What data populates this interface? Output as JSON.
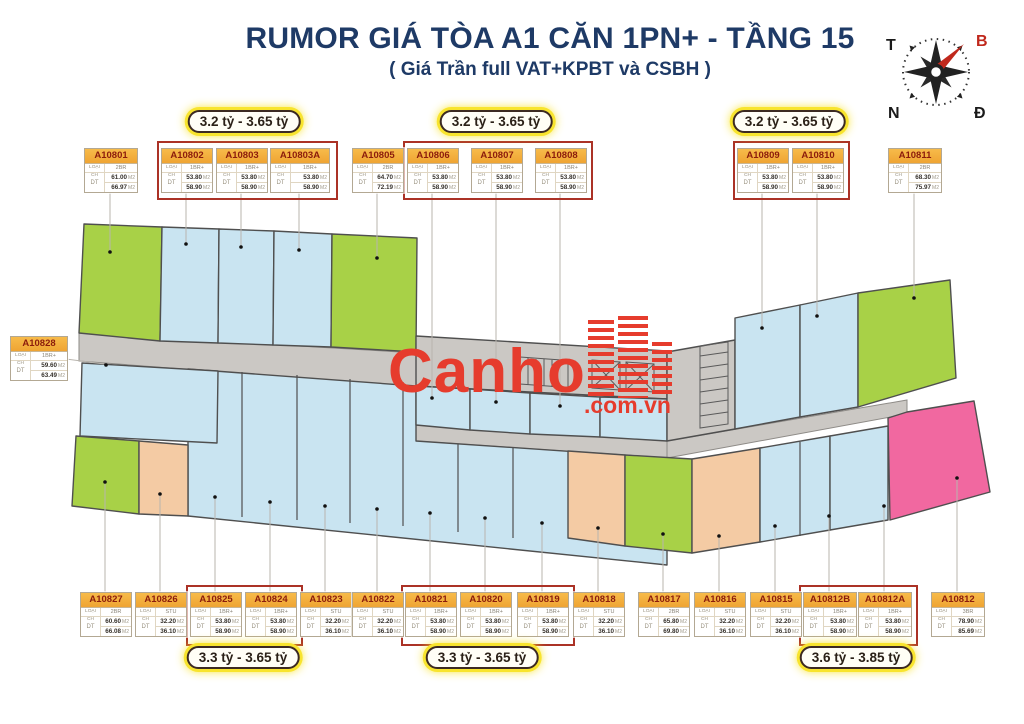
{
  "title": "RUMOR GIÁ TÒA A1 CĂN 1PN+ - TẦNG 15",
  "subtitle": "( Giá Trần full VAT+KPBT và CSBH )",
  "watermark": {
    "brand": "Canho",
    "suffix": ".com.vn"
  },
  "compass": {
    "top_left": "T",
    "top_right": "B",
    "bottom_left": "N",
    "bottom_right": "Đ"
  },
  "labels": {
    "type_label": "LOẠI CH",
    "area_label": "DT",
    "area_unit": "M2"
  },
  "palette": {
    "accent_navy": "#1e3a66",
    "brand_red": "#e63c2d",
    "badge_glow": "#f8e42e",
    "group_border": "#ab3226",
    "card_header_orange": "#f2a93c",
    "card_id_red": "#8c1c0c",
    "unit_green": "#a8d147",
    "unit_blue": "#c9e4f1",
    "unit_orange": "#f4cba4",
    "unit_pink": "#f168a0",
    "core_gray": "#cbc8c4"
  },
  "badges": {
    "top": [
      "3.2 tỷ - 3.65 tỷ",
      "3.2 tỷ - 3.65 tỷ",
      "3.2 tỷ - 3.65 tỷ"
    ],
    "bottom": [
      "3.3 tỷ - 3.65 tỷ",
      "3.3 tỷ - 3.65 tỷ",
      "3.6 tỷ - 3.85 tỷ"
    ]
  },
  "units": {
    "top_row": [
      {
        "id": "A10801",
        "type": "2BR",
        "area1": "61.00",
        "area2": "66.97"
      },
      {
        "id": "A10802",
        "type": "1BR+",
        "area1": "53.80",
        "area2": "58.90"
      },
      {
        "id": "A10803",
        "type": "1BR+",
        "area1": "53.80",
        "area2": "58.90"
      },
      {
        "id": "A10803A",
        "type": "1BR+",
        "area1": "53.80",
        "area2": "58.90"
      },
      {
        "id": "A10805",
        "type": "2BR",
        "area1": "64.70",
        "area2": "72.19"
      },
      {
        "id": "A10806",
        "type": "1BR+",
        "area1": "53.80",
        "area2": "58.90"
      },
      {
        "id": "A10807",
        "type": "1BR+",
        "area1": "53.80",
        "area2": "58.90"
      },
      {
        "id": "A10808",
        "type": "1BR+",
        "area1": "53.80",
        "area2": "58.90"
      },
      {
        "id": "A10809",
        "type": "1BR+",
        "area1": "53.80",
        "area2": "58.90"
      },
      {
        "id": "A10810",
        "type": "1BR+",
        "area1": "53.80",
        "area2": "58.90"
      },
      {
        "id": "A10811",
        "type": "2BR",
        "area1": "68.30",
        "area2": "75.97"
      }
    ],
    "side": {
      "id": "A10828",
      "type": "1BR+",
      "area1": "59.60",
      "area2": "63.49"
    },
    "bottom_row": [
      {
        "id": "A10827",
        "type": "2BR",
        "area1": "60.60",
        "area2": "66.08"
      },
      {
        "id": "A10826",
        "type": "STU",
        "area1": "32.20",
        "area2": "36.10"
      },
      {
        "id": "A10825",
        "type": "1BR+",
        "area1": "53.80",
        "area2": "58.90"
      },
      {
        "id": "A10824",
        "type": "1BR+",
        "area1": "53.80",
        "area2": "58.90"
      },
      {
        "id": "A10823",
        "type": "STU",
        "area1": "32.20",
        "area2": "36.10"
      },
      {
        "id": "A10822",
        "type": "STU",
        "area1": "32.20",
        "area2": "36.10"
      },
      {
        "id": "A10821",
        "type": "1BR+",
        "area1": "53.80",
        "area2": "58.90"
      },
      {
        "id": "A10820",
        "type": "1BR+",
        "area1": "53.80",
        "area2": "58.90"
      },
      {
        "id": "A10819",
        "type": "1BR+",
        "area1": "53.80",
        "area2": "58.90"
      },
      {
        "id": "A10818",
        "type": "STU",
        "area1": "32.20",
        "area2": "36.10"
      },
      {
        "id": "A10817",
        "type": "2BR",
        "area1": "65.80",
        "area2": "69.80"
      },
      {
        "id": "A10816",
        "type": "STU",
        "area1": "32.20",
        "area2": "36.10"
      },
      {
        "id": "A10815",
        "type": "STU",
        "area1": "32.20",
        "area2": "36.10"
      },
      {
        "id": "A10812B",
        "type": "1BR+",
        "area1": "53.80",
        "area2": "58.90"
      },
      {
        "id": "A10812A",
        "type": "1BR+",
        "area1": "53.80",
        "area2": "58.90"
      },
      {
        "id": "A10812",
        "type": "3BR",
        "area1": "78.90",
        "area2": "85.69"
      }
    ]
  }
}
